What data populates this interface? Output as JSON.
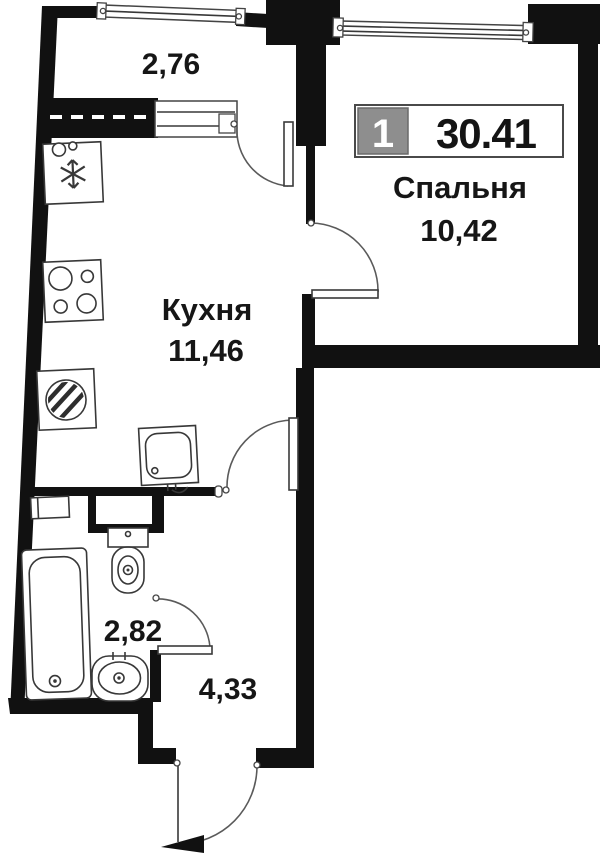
{
  "plan": {
    "kind": "apartment-floor-plan",
    "badge": {
      "rooms_count": "1",
      "total_area": "30.41"
    },
    "rooms": {
      "balcony": {
        "area": "2,76"
      },
      "bedroom": {
        "name": "Спальня",
        "area": "10,42"
      },
      "kitchen": {
        "name": "Кухня",
        "area": "11,46"
      },
      "bathroom": {
        "area": "2,82"
      },
      "hallway": {
        "area": "4,33"
      }
    },
    "icons": {
      "fixtures": [
        "fridge-icon",
        "stove-icon",
        "washing-machine-icon",
        "kitchen-sink-icon",
        "toilet-icon",
        "bathtub-icon",
        "bathroom-sink-icon",
        "shelf-icon"
      ],
      "openings": [
        "balcony-window",
        "bedroom-window",
        "balcony-door",
        "bedroom-door",
        "kitchen-door",
        "bathroom-door",
        "entrance-door"
      ]
    },
    "colors": {
      "background": "#ffffff",
      "walls": "#111111",
      "badge_gray": "#8e8e8e",
      "text": "#161616"
    }
  }
}
